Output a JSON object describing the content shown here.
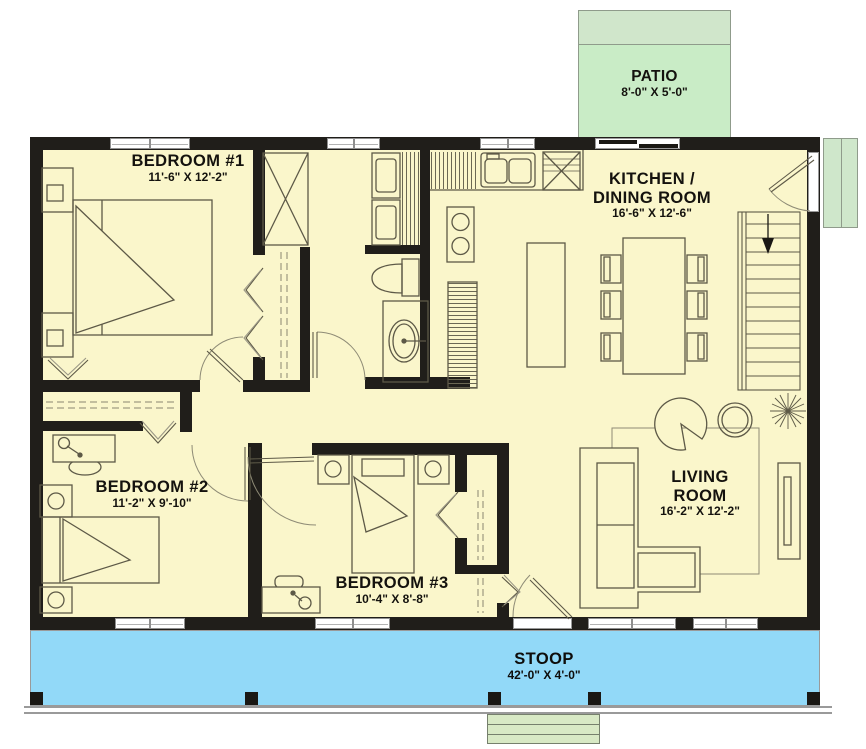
{
  "plan": {
    "patio": {
      "name": "PATIO",
      "dims": "8'-0\" X 5'-0\""
    },
    "stoop": {
      "name": "STOOP",
      "dims": "42'-0\" X 4'-0\""
    },
    "rooms": {
      "bedroom1": {
        "name": "BEDROOM #1",
        "dims": "11'-6\" X 12'-2\""
      },
      "bedroom2": {
        "name": "BEDROOM #2",
        "dims": "11'-2\" X 9'-10\""
      },
      "bedroom3": {
        "name": "BEDROOM #3",
        "dims": "10'-4\" X 8'-8\""
      },
      "kitchen_dining": {
        "line1": "KITCHEN /",
        "line2": "DINING ROOM",
        "dims": "16'-6\" X 12'-6\""
      },
      "living": {
        "line1": "LIVING",
        "line2": "ROOM",
        "dims": "16'-2\" X 12'-2\""
      }
    },
    "colors": {
      "floor": "#FAF6CB",
      "wall": "#201E1A",
      "patio": "#C9ECC6",
      "patio_band": "#D0E6CB",
      "stoop": "#92D9F8",
      "steps": "#D8E9C5"
    }
  }
}
